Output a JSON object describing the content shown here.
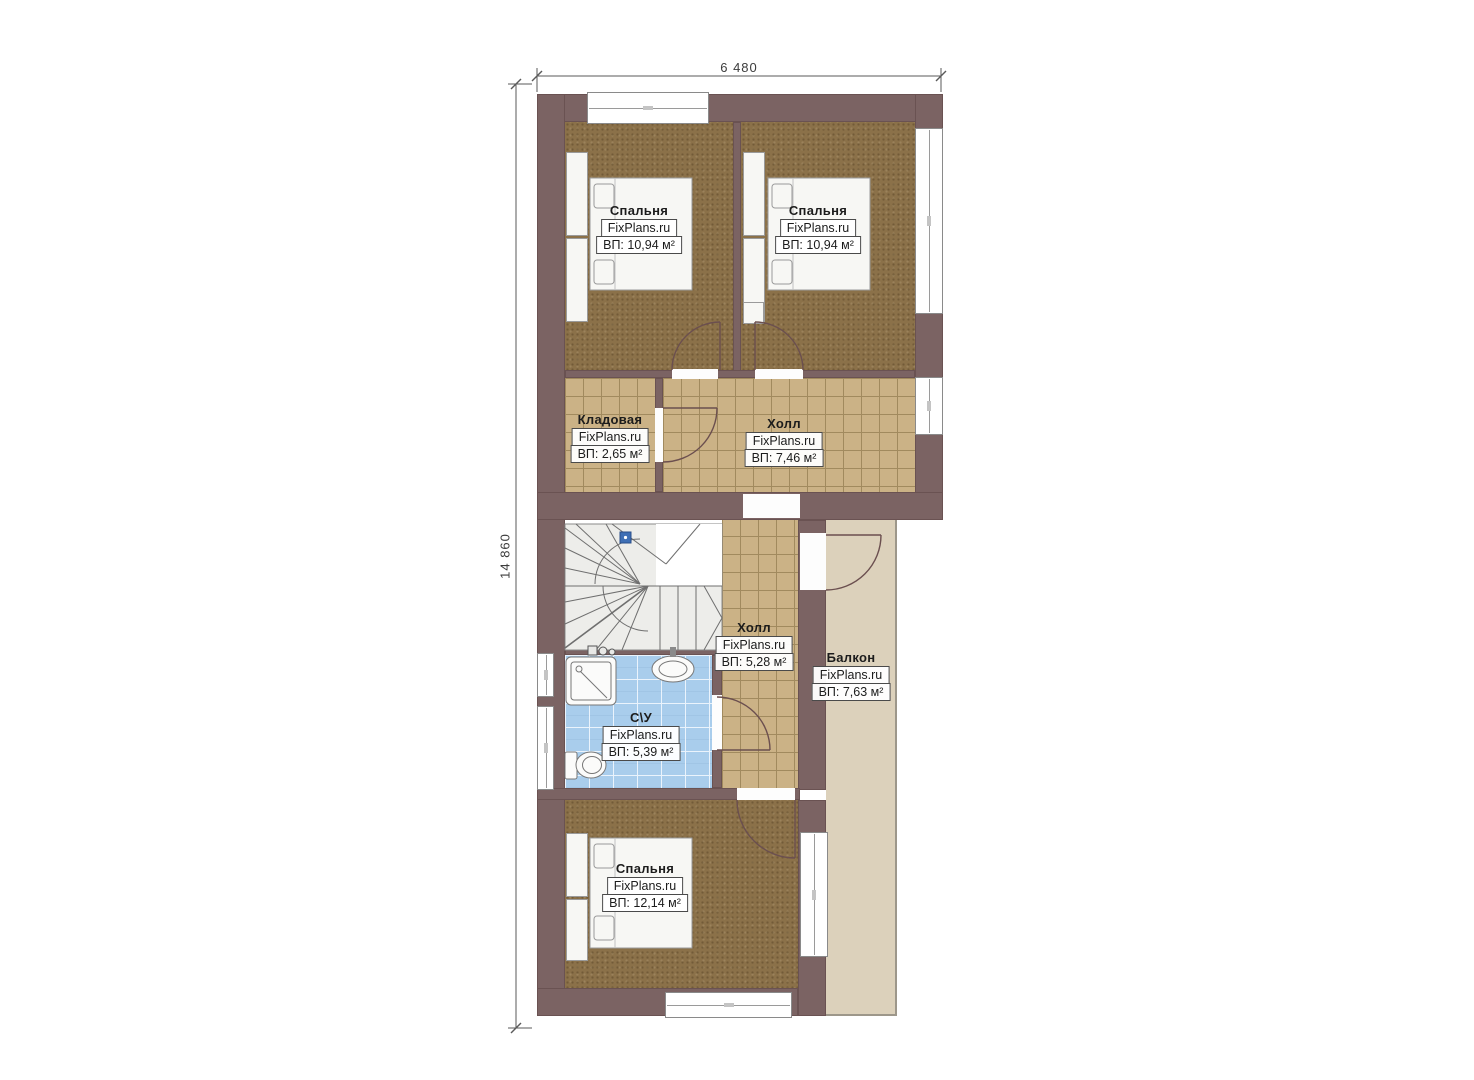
{
  "drawing": {
    "type": "floor-plan",
    "brand": "FixPlans.ru",
    "dimensions": {
      "width": "6 480",
      "height": "14 860"
    },
    "colors": {
      "wall": "#7b6363",
      "carpet": "#8b7149",
      "tile": "#cbb286",
      "bathroom_tile": "#a9cdec",
      "balcony": "#dcd1bb",
      "stairs": "#ededea",
      "marker_blue": "#3f6fb5"
    },
    "rooms": [
      {
        "key": "bedroom-top-left",
        "name": "Спальня",
        "area": "ВП: 10,94 м²"
      },
      {
        "key": "bedroom-top-right",
        "name": "Спальня",
        "area": "ВП: 10,94 м²"
      },
      {
        "key": "storage",
        "name": "Кладовая",
        "area": "ВП: 2,65 м²"
      },
      {
        "key": "hall-upper",
        "name": "Холл",
        "area": "ВП: 7,46 м²"
      },
      {
        "key": "hall-lower",
        "name": "Холл",
        "area": "ВП: 5,28 м²"
      },
      {
        "key": "balcony",
        "name": "Балкон",
        "area": "ВП: 7,63 м²"
      },
      {
        "key": "bathroom",
        "name": "С\\У",
        "area": "ВП: 5,39 м²"
      },
      {
        "key": "bedroom-bottom",
        "name": "Спальня",
        "area": "ВП: 12,14 м²"
      }
    ]
  }
}
